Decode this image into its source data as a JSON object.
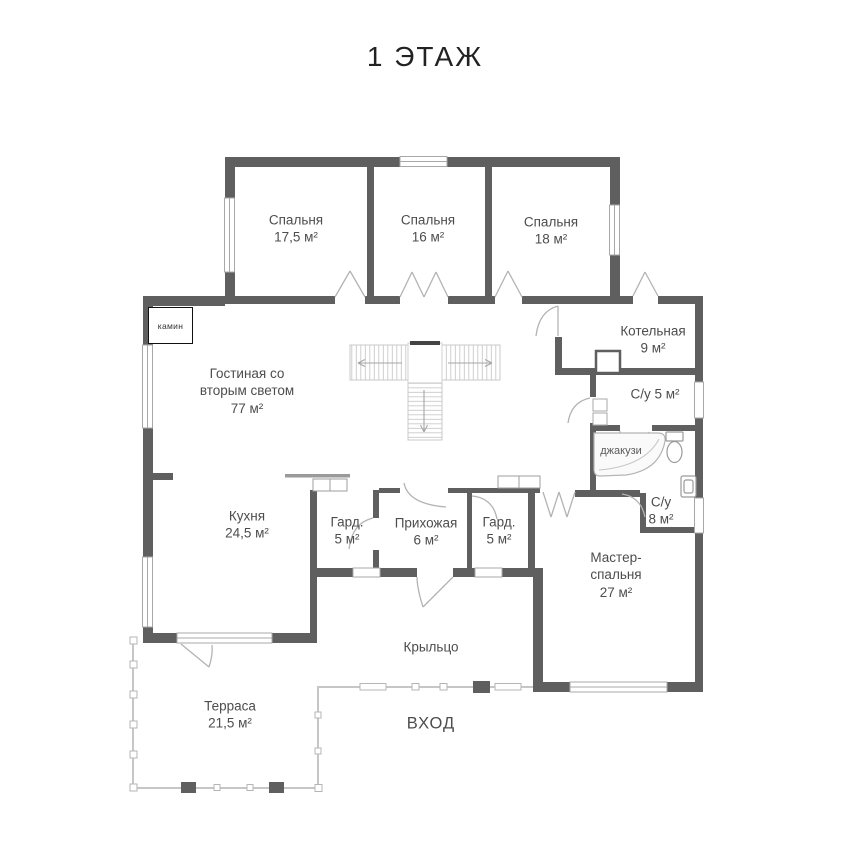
{
  "title": "1 ЭТАЖ",
  "rooms": {
    "bedroom1": {
      "name": "Спальня",
      "area": "17,5 м²"
    },
    "bedroom2": {
      "name": "Спальня",
      "area": "16 м²"
    },
    "bedroom3": {
      "name": "Спальня",
      "area": "18 м²"
    },
    "boiler": {
      "name": "Котельная",
      "area": "9 м²"
    },
    "wc5": {
      "name": "С/у 5 м²"
    },
    "jacuzzi": {
      "name": "джакузи"
    },
    "wc8": {
      "name": "С/у",
      "area": "8 м²"
    },
    "living": {
      "line1": "Гостиная со",
      "line2": "вторым светом",
      "area": "77 м²"
    },
    "kitchen": {
      "name": "Кухня",
      "area": "24,5 м²"
    },
    "wardrobe1": {
      "name": "Гард.",
      "area": "5 м²"
    },
    "hallway": {
      "name": "Прихожая",
      "area": "6 м²"
    },
    "wardrobe2": {
      "name": "Гард.",
      "area": "5 м²"
    },
    "master": {
      "line1": "Мастер-",
      "line2": "спальня",
      "area": "27 м²"
    },
    "porch": {
      "name": "Крыльцо"
    },
    "terrace": {
      "name": "Терраса",
      "area": "21,5 м²"
    },
    "entrance": {
      "name": "ВХОД"
    },
    "fireplace": {
      "name": "камин"
    }
  },
  "colors": {
    "wall": "#5f5f5f",
    "thin_line": "#c6c6c6",
    "text": "#4d4d4d"
  }
}
